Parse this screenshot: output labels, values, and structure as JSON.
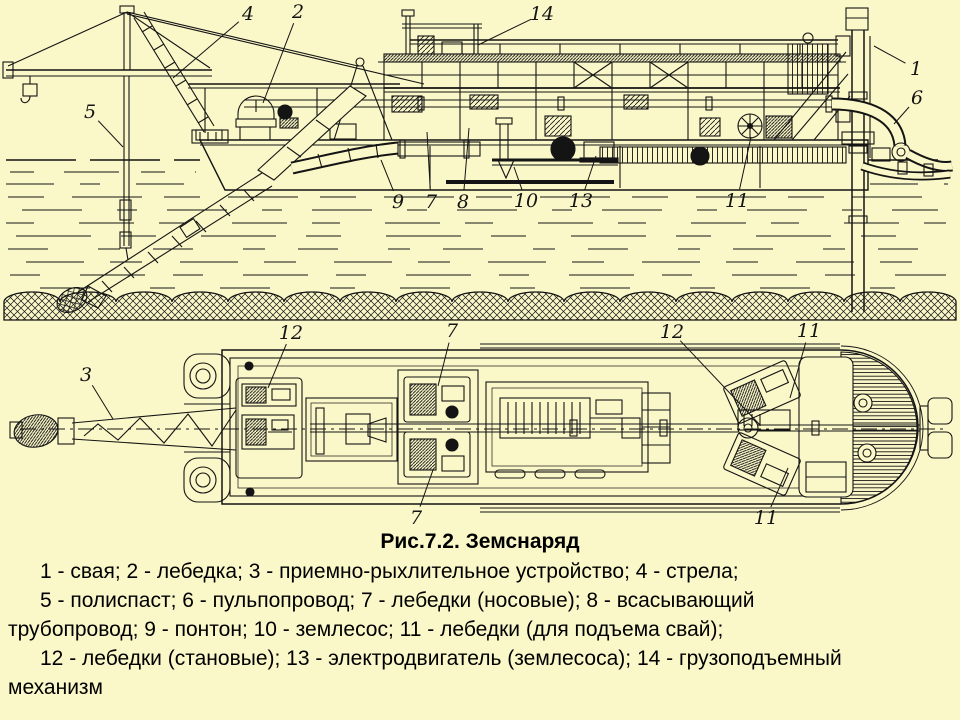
{
  "colors": {
    "background": "#faf7c8",
    "ink": "#141414"
  },
  "caption": {
    "title": "Рис.7.2. Земснаряд",
    "lines": [
      {
        "indent": true,
        "text": "1 - свая; 2 - лебедка; 3 - приемно-рыхлительное устройство; 4 - стрела;"
      },
      {
        "indent": true,
        "text": "5 - полиспаст; 6 - пульпопровод; 7 - лебедки (носовые); 8 - всасывающий"
      },
      {
        "indent": false,
        "text": "трубопровод; 9 - понтон; 10 - землесос; 11 - лебедки (для подъема свай);"
      },
      {
        "indent": true,
        "text": "12 - лебедки (становые); 13 - электродвигатель (землесоса); 14 - грузоподъемный"
      },
      {
        "indent": false,
        "text": "механизм"
      }
    ]
  },
  "legend_items": [
    {
      "number": "1",
      "label": "свая"
    },
    {
      "number": "2",
      "label": "лебедка"
    },
    {
      "number": "3",
      "label": "приемно-рыхлительное устройство"
    },
    {
      "number": "4",
      "label": "стрела"
    },
    {
      "number": "5",
      "label": "полиспаст"
    },
    {
      "number": "6",
      "label": "пульпопровод"
    },
    {
      "number": "7",
      "label": "лебедки (носовые)"
    },
    {
      "number": "8",
      "label": "всасывающий трубопровод"
    },
    {
      "number": "9",
      "label": "понтон"
    },
    {
      "number": "10",
      "label": "землесос"
    },
    {
      "number": "11",
      "label": "лебедки (для подъема свай)"
    },
    {
      "number": "12",
      "label": "лебедки (становые)"
    },
    {
      "number": "13",
      "label": "электродвигатель (землесоса)"
    },
    {
      "number": "14",
      "label": "грузоподъемный механизм"
    }
  ],
  "callouts": {
    "side_view": [
      {
        "label": "4",
        "x": 248,
        "y": 14,
        "tx": 173,
        "ty": 78
      },
      {
        "label": "2",
        "x": 298,
        "y": 12,
        "tx": 263,
        "ty": 103
      },
      {
        "label": "14",
        "x": 542,
        "y": 14,
        "tx": 478,
        "ty": 45
      },
      {
        "label": "1",
        "x": 916,
        "y": 69,
        "tx": 874,
        "ty": 46
      },
      {
        "label": "6",
        "x": 917,
        "y": 98,
        "tx": 894,
        "ty": 124
      },
      {
        "label": "5",
        "x": 90,
        "y": 112,
        "tx": 123,
        "ty": 147
      },
      {
        "label": "9",
        "x": 398,
        "y": 202,
        "tx": 381,
        "ty": 160
      },
      {
        "label": "7",
        "x": 431,
        "y": 202,
        "tx": 427,
        "ty": 132
      },
      {
        "label": "8",
        "x": 463,
        "y": 202,
        "tx": 469,
        "ty": 128
      },
      {
        "label": "10",
        "x": 526,
        "y": 201,
        "tx": 514,
        "ty": 167
      },
      {
        "label": "13",
        "x": 581,
        "y": 201,
        "tx": 596,
        "ty": 156
      },
      {
        "label": "11",
        "x": 737,
        "y": 201,
        "tx": 751,
        "ty": 137
      }
    ],
    "plan_view": [
      {
        "label": "3",
        "x": 86,
        "y": 375,
        "tx": 113,
        "ty": 419
      },
      {
        "label": "12",
        "x": 291,
        "y": 333,
        "tx": 268,
        "ty": 388
      },
      {
        "label": "7",
        "x": 452,
        "y": 331,
        "tx": 438,
        "ty": 386
      },
      {
        "label": "12",
        "x": 672,
        "y": 332,
        "tx": 760,
        "ty": 425
      },
      {
        "label": "11",
        "x": 809,
        "y": 331,
        "tx": 790,
        "ty": 398
      },
      {
        "label": "7",
        "x": 416,
        "y": 518,
        "tx": 433,
        "ty": 470
      },
      {
        "label": "11",
        "x": 766,
        "y": 518,
        "tx": 788,
        "ty": 468
      }
    ]
  }
}
